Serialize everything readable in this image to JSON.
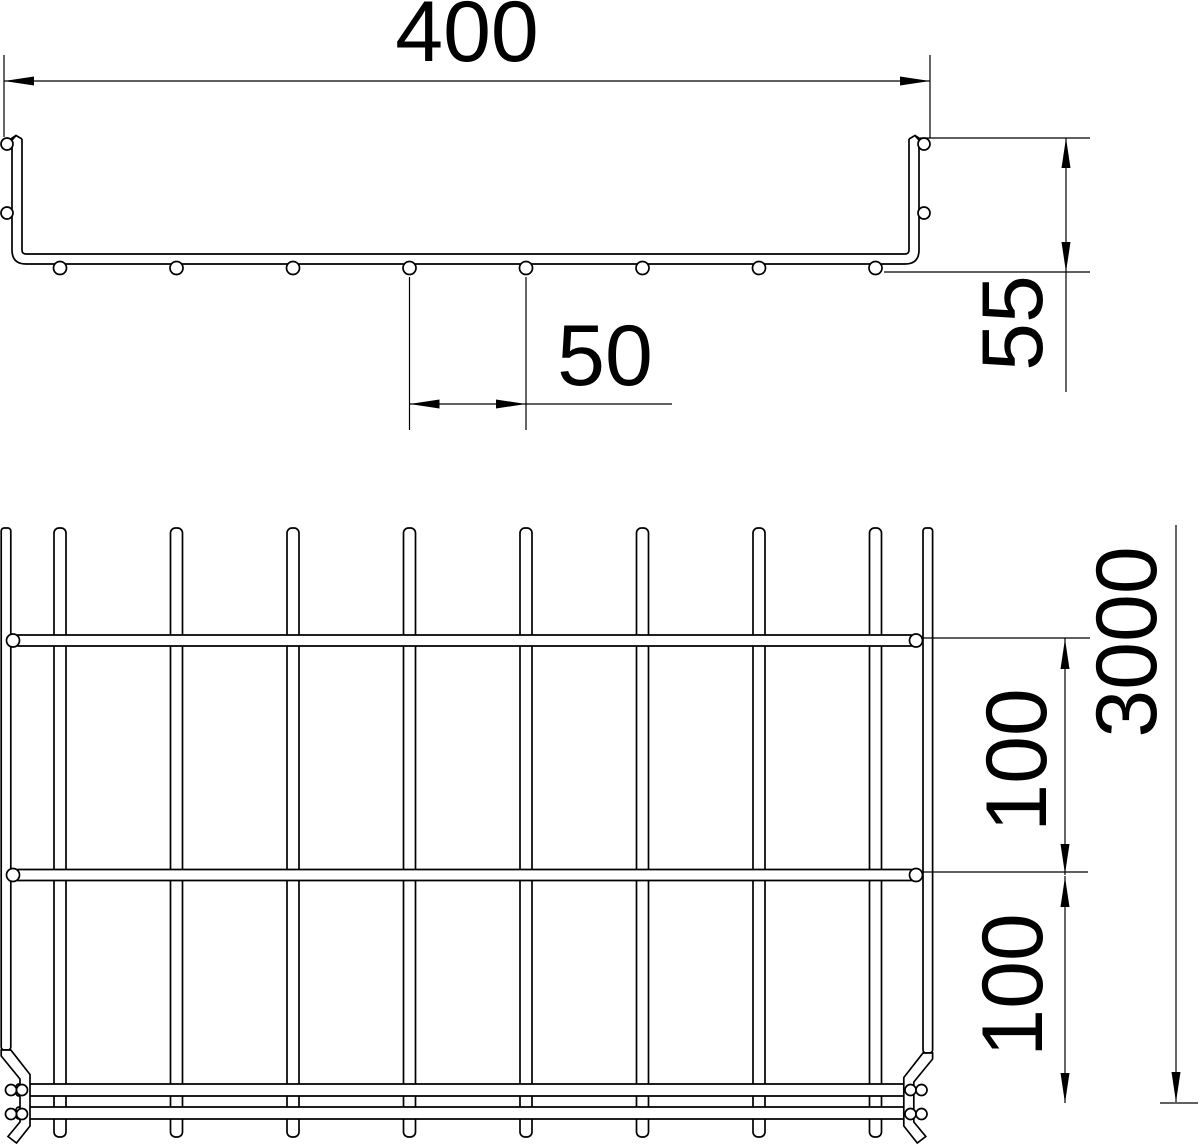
{
  "colors": {
    "background": "#ffffff",
    "line": "#000000"
  },
  "labels": {
    "tray_width": "400",
    "tray_height": "55",
    "bottom_wire_spacing": "50",
    "rung_pitch_upper": "100",
    "rung_pitch_lower": "100",
    "tray_length": "3000"
  },
  "structure": {
    "cross_section": {
      "bottom_wires": 8,
      "side_wires_per_wall": 2
    },
    "plan_view": {
      "inner_longitudinal_wires": 8,
      "edge_longitudinal_wires": 2,
      "full_rungs_visible": 2,
      "end_rungs_visible": 2
    }
  }
}
